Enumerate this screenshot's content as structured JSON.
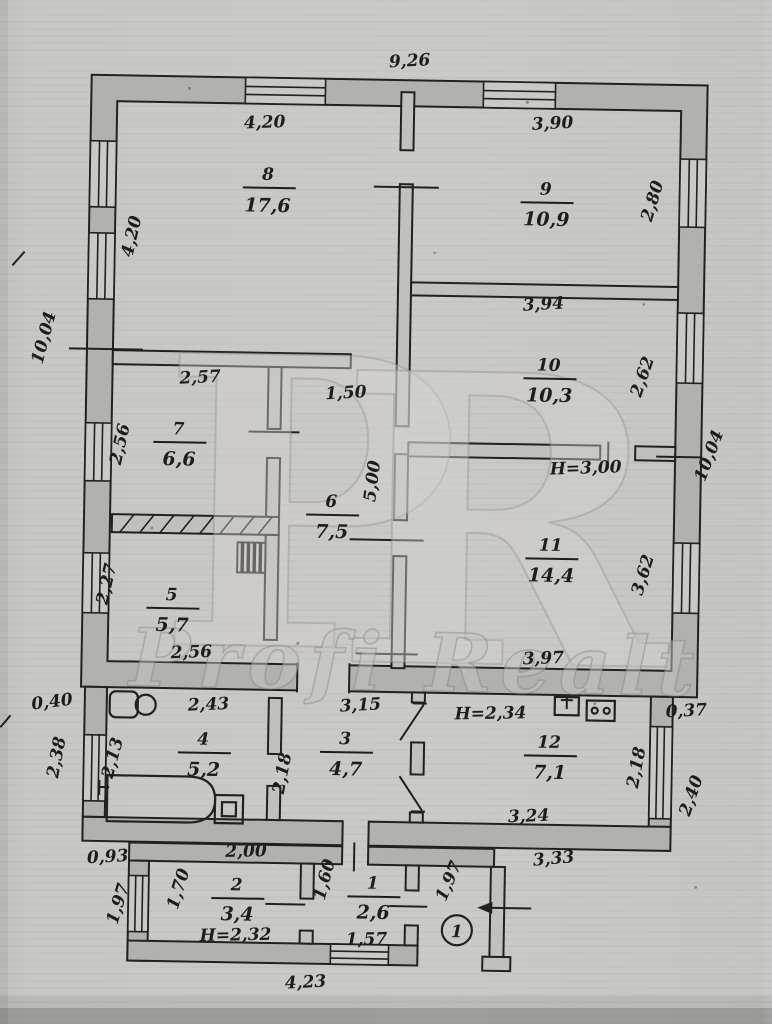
{
  "watermark": {
    "letter_p": "P",
    "letter_r": "R",
    "brand": "Profi Realt"
  },
  "entrance_badge": "1",
  "rooms": [
    {
      "number": "1",
      "area": "2,6"
    },
    {
      "number": "2",
      "area": "3,4"
    },
    {
      "number": "3",
      "area": "4,7"
    },
    {
      "number": "4",
      "area": "5,2"
    },
    {
      "number": "5",
      "area": "5,7"
    },
    {
      "number": "6",
      "area": "7,5"
    },
    {
      "number": "7",
      "area": "6,6"
    },
    {
      "number": "8",
      "area": "17,6"
    },
    {
      "number": "9",
      "area": "10,9"
    },
    {
      "number": "10",
      "area": "10,3"
    },
    {
      "number": "11",
      "area": "14,4"
    },
    {
      "number": "12",
      "area": "7,1"
    }
  ],
  "dims": {
    "top_width": "9,26",
    "room8_width": "4,20",
    "room8_height": "4,20",
    "left_height": "10,04",
    "room9_width": "3,90",
    "room9_height": "2,80",
    "room10_width": "3,94",
    "room10_height": "2,62",
    "right_height": "10,04",
    "h_main": "H=3,00",
    "room7_width": "2,57",
    "room7_height": "2,56",
    "hall_width": "1,50",
    "hall_height": "5,00",
    "room11_height": "3,62",
    "room5_height": "2,27",
    "room5_width": "2,56",
    "room11_width": "3,97",
    "offset_left": "0,40",
    "room4_width": "2,43",
    "room3_width": "3,15",
    "h_annex": "H=2,34",
    "offset_right": "0,37",
    "annex_left_outer": "2,38",
    "room4_height": "2,13",
    "room3_height": "2,18",
    "room12_height": "2,18",
    "annex_right_outer": "2,40",
    "room12_width": "3,24",
    "offset_bottom_left": "0,93",
    "room2_width": "2,00",
    "room2_height": "1,70",
    "room1_height": "1,60",
    "h_annex2": "H=2,32",
    "room1_width": "1,57",
    "porch_height": "1,97",
    "porch_width": "3,33",
    "bottom_width": "4,23",
    "annex2_left_outer": "1,97"
  }
}
